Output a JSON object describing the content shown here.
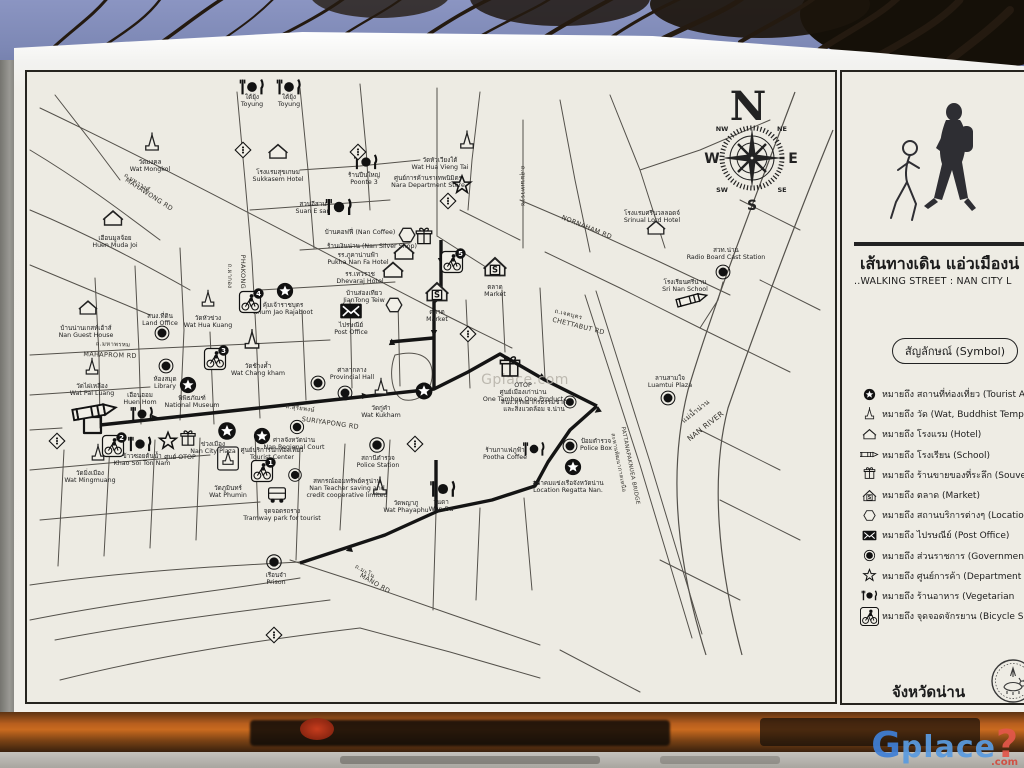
{
  "colors": {
    "sky": "#7d88b5",
    "paper": "#edebe3",
    "ink": "#1c1c1c",
    "wood": "#b85f1e",
    "logo_blue": "#3f7fd6",
    "logo_red": "#e2574a"
  },
  "sign": {
    "title_th": "เส้นทางเดิน แอ่วเมืองน่",
    "title_en": "..WALKING STREET : NAN CITY L",
    "symbol_header": "สัญลักษณ์ (Symbol)",
    "province": "จังหวัดน่าน",
    "legend": [
      {
        "icon": "star-solid",
        "text": "หมายถึง สถานที่ท่องเที่ยว (Tourist Att"
      },
      {
        "icon": "wat",
        "text": "หมายถึง วัด (Wat, Buddhist Temple"
      },
      {
        "icon": "house",
        "text": "หมายถึง โรงแรม (Hotel)"
      },
      {
        "icon": "pencil",
        "text": "หมายถึง โรงเรียน (School)"
      },
      {
        "icon": "gift",
        "text": "หมายถึง ร้านขายของที่ระลึก (Souven"
      },
      {
        "icon": "market",
        "text": "หมายถึง ตลาด (Market)"
      },
      {
        "icon": "hex",
        "text": "หมายถึง สถานบริการต่างๆ (Locatio"
      },
      {
        "icon": "post",
        "text": "หมายถึง ไปรษณีย์ (Post Office)"
      },
      {
        "icon": "gov",
        "text": "หมายถึง ส่วนราชการ (Government"
      },
      {
        "icon": "star-outline",
        "text": "หมายถึง ศูนย์การค้า (Department S"
      },
      {
        "icon": "rest",
        "text": "หมายถึง ร้านอาหาร (Vegetarian"
      },
      {
        "icon": "bike",
        "text": "หมายถึง จุดจอดจักรยาน (Bicycle S"
      }
    ]
  },
  "map": {
    "watermark": "Gplace.com",
    "compass": {
      "n": "N",
      "s": "S",
      "e": "E",
      "w": "W",
      "nw": "NW",
      "ne": "NE",
      "sw": "SW",
      "se": "SE"
    },
    "roads": [
      {
        "text": "ถ.มหาวงศ์",
        "x": 136,
        "y": 184,
        "rot": 33,
        "size": 6
      },
      {
        "text": "MAHAWONG RD",
        "x": 148,
        "y": 196,
        "rot": 33,
        "size": 6.5
      },
      {
        "text": "ถ.มหาพรหม",
        "x": 113,
        "y": 346,
        "rot": 2,
        "size": 6
      },
      {
        "text": "MAHAPROM RD",
        "x": 110,
        "y": 357,
        "rot": 2,
        "size": 6.5
      },
      {
        "text": "ถ.ผากอง",
        "x": 228,
        "y": 276,
        "rot": 90,
        "size": 6
      },
      {
        "text": "PHAKONG RD",
        "x": 241,
        "y": 278,
        "rot": 90,
        "size": 6.5
      },
      {
        "text": "ถ.สุริยพงษ์",
        "x": 300,
        "y": 410,
        "rot": 8,
        "size": 6
      },
      {
        "text": "SURIYAPONG RD",
        "x": 330,
        "y": 425,
        "rot": 8,
        "size": 6.5
      },
      {
        "text": "ถ.สุมนเทวราช",
        "x": 521,
        "y": 186,
        "rot": 90,
        "size": 6
      },
      {
        "text": "NORNAHAM RD",
        "x": 586,
        "y": 229,
        "rot": 22,
        "size": 6.5
      },
      {
        "text": "ถ.เจตบุตร",
        "x": 568,
        "y": 316,
        "rot": 14,
        "size": 6
      },
      {
        "text": "CHETTABUT RD",
        "x": 578,
        "y": 328,
        "rot": 14,
        "size": 6.5
      },
      {
        "text": "ถ.มะโน",
        "x": 364,
        "y": 573,
        "rot": 30,
        "size": 6
      },
      {
        "text": "MANO RD",
        "x": 374,
        "y": 585,
        "rot": 30,
        "size": 6.5
      },
      {
        "text": "แม่น้ำน่าน",
        "x": 697,
        "y": 413,
        "rot": -38,
        "size": 7
      },
      {
        "text": "NAN RIVER",
        "x": 707,
        "y": 428,
        "rot": -38,
        "size": 7.5
      },
      {
        "text": "สะพานพัฒนาภาคเหนือ",
        "x": 617,
        "y": 463,
        "rot": 79,
        "size": 5.5
      },
      {
        "text": "PATTANAPAKNUEA BRIDGE",
        "x": 629,
        "y": 466,
        "rot": 79,
        "size": 5.5
      }
    ],
    "pois": [
      {
        "t": "wat",
        "x": 152,
        "y": 150,
        "s": 1.3,
        "lines": [
          "วัดมงคล",
          "Wat Mongkol"
        ],
        "lx": 150,
        "ly": 164
      },
      {
        "t": "wat",
        "x": 467,
        "y": 148,
        "s": 1.3,
        "lines": [
          "วัดหัวเวียงใต้",
          "Wat Hua Vieng Tai"
        ],
        "lx": 440,
        "ly": 162
      },
      {
        "t": "wat",
        "x": 208,
        "y": 306,
        "s": 1.2,
        "lines": [
          "วัดหัวข่วง",
          "Wat Hua Kuang"
        ],
        "lx": 208,
        "ly": 320
      },
      {
        "t": "wat",
        "x": 92,
        "y": 374,
        "s": 1.2,
        "lines": [
          "วัดไผ่เหลือง",
          "Wat Pai Luang"
        ],
        "lx": 92,
        "ly": 388
      },
      {
        "t": "wat",
        "x": 252,
        "y": 348,
        "s": 1.4,
        "lines": [
          "วัดช้างค้ำ",
          "Wat Chang kham"
        ],
        "lx": 258,
        "ly": 368
      },
      {
        "t": "wat-box",
        "x": 228,
        "y": 466,
        "s": 1.15,
        "lines": [
          "วัดภูมินทร์",
          "Wat Phumin"
        ],
        "lx": 228,
        "ly": 490
      },
      {
        "t": "wat",
        "x": 98,
        "y": 460,
        "s": 1.2,
        "lines": [
          "วัดมิ่งเมือง",
          "Wat Mingmuang"
        ],
        "lx": 90,
        "ly": 475
      },
      {
        "t": "wat",
        "x": 381,
        "y": 394,
        "s": 1.2,
        "lines": [
          "วัดกู่คำ",
          "Wat Kukham"
        ],
        "lx": 381,
        "ly": 410
      },
      {
        "t": "wat",
        "x": 380,
        "y": 494,
        "s": 1.3,
        "lines": [
          "วัดพญาภู",
          "Wat Phayaphu"
        ],
        "lx": 406,
        "ly": 505
      },
      {
        "t": "house",
        "x": 113,
        "y": 225,
        "s": 1.3,
        "lines": [
          "เฮือนมูลจ้อย",
          "Huen Muda Joi"
        ],
        "lx": 115,
        "ly": 240
      },
      {
        "t": "house",
        "x": 88,
        "y": 314,
        "s": 1.2,
        "lines": [
          "บ้านน่านเกสท์เฮ้าส์",
          "Nan Guest House"
        ],
        "lx": 86,
        "ly": 330
      },
      {
        "t": "house",
        "x": 278,
        "y": 158,
        "s": 1.25,
        "lines": [
          "โรงแรมสุขเกษม",
          "Sukkasem Hotel"
        ],
        "lx": 278,
        "ly": 174
      },
      {
        "t": "house",
        "x": 404,
        "y": 259,
        "s": 1.35,
        "lines": [
          "รร.ภูคาน่านฟ้า",
          "Pukha Nan Fa Hotel"
        ],
        "lx": 358,
        "ly": 257
      },
      {
        "t": "house",
        "x": 393,
        "y": 277,
        "s": 1.35,
        "lines": [
          "รร.เทวราช",
          "Dhevaraj Hotel"
        ],
        "lx": 360,
        "ly": 276
      },
      {
        "t": "house",
        "x": 656,
        "y": 234,
        "s": 1.2,
        "lines": [
          "โรงแรมศรีนวลลอดจ์",
          "Srinual Lord Hotel"
        ],
        "lx": 652,
        "ly": 215
      },
      {
        "t": "rest",
        "x": 252,
        "y": 87,
        "s": 1.35,
        "lines": [
          "ใต้ยุ้ง",
          "Toyung"
        ],
        "lx": 252,
        "ly": 99
      },
      {
        "t": "rest",
        "x": 289,
        "y": 87,
        "s": 1.35,
        "lines": [
          "ใต้ยุ้ง",
          "Toyung"
        ],
        "lx": 289,
        "ly": 99
      },
      {
        "t": "rest",
        "x": 339,
        "y": 207,
        "s": 1.45,
        "lines": [
          "สวนอีสาน",
          "Suan E san"
        ],
        "lx": 313,
        "ly": 206
      },
      {
        "t": "rest",
        "x": 366,
        "y": 162,
        "s": 1.3,
        "lines": [
          "ร้านปืนใหญ่",
          "Poonte 3"
        ],
        "lx": 364,
        "ly": 177
      },
      {
        "t": "rest",
        "x": 142,
        "y": 414,
        "s": 1.25,
        "lines": [
          "เฮือนฮอม",
          "Huen Hom"
        ],
        "lx": 140,
        "ly": 397
      },
      {
        "t": "rest",
        "x": 140,
        "y": 444,
        "s": 1.3,
        "lines": [
          "ข้าวซอยต้นน้ำ",
          "Khao Soi Ton Nam"
        ],
        "lx": 142,
        "ly": 458
      },
      {
        "t": "rest",
        "x": 443,
        "y": 489,
        "s": 1.4,
        "lines": [
          "วันดา",
          "Wun Da"
        ],
        "lx": 441,
        "ly": 504
      },
      {
        "t": "rest",
        "x": 534,
        "y": 449,
        "s": 1.2,
        "lines": [
          "ร้านกาแฟภูฟ้า",
          "Pootha Coffee"
        ],
        "lx": 505,
        "ly": 452
      },
      {
        "t": "market",
        "x": 495,
        "y": 274,
        "s": 1.5,
        "lines": [
          "ตลาด",
          "Market"
        ],
        "lx": 495,
        "ly": 289
      },
      {
        "t": "market",
        "x": 437,
        "y": 299,
        "s": 1.5,
        "lines": [
          "ตลาด",
          "Market"
        ],
        "lx": 437,
        "ly": 314
      },
      {
        "t": "post",
        "x": 351,
        "y": 311,
        "s": 1.35,
        "lines": [
          "ไปรษณีย์",
          "Post Office"
        ],
        "lx": 351,
        "ly": 327
      },
      {
        "t": "gov",
        "x": 162,
        "y": 333,
        "s": 1.15,
        "lines": [
          "สนง.ที่ดิน",
          "Land Office"
        ],
        "lx": 160,
        "ly": 318
      },
      {
        "t": "gov",
        "x": 166,
        "y": 366,
        "s": 1.15,
        "lines": [
          "ห้องสมุด",
          "Library"
        ],
        "lx": 165,
        "ly": 381
      },
      {
        "t": "gov",
        "x": 318,
        "y": 383,
        "s": 1.15,
        "lines": [
          "ศาลากลาง",
          "Provincial Hall"
        ],
        "lx": 352,
        "ly": 372
      },
      {
        "t": "gov",
        "x": 345,
        "y": 393,
        "s": 1.15
      },
      {
        "t": "gov",
        "x": 297,
        "y": 427,
        "s": 1.1,
        "lines": [
          "ศาลจังหวัดน่าน",
          "Nan Regional Court"
        ],
        "lx": 294,
        "ly": 442
      },
      {
        "t": "gov",
        "x": 377,
        "y": 445,
        "s": 1.2,
        "lines": [
          "สถานีตำรวจ",
          "Police Station"
        ],
        "lx": 378,
        "ly": 460
      },
      {
        "t": "gov",
        "x": 295,
        "y": 475,
        "s": 1.05,
        "lines": [
          "สหกรณ์ออมทรัพย์ครูน่าน",
          "Nan Teacher saving and",
          "credit cooperative limited"
        ],
        "lx": 347,
        "ly": 483
      },
      {
        "t": "gov",
        "x": 570,
        "y": 446,
        "s": 1.15,
        "lines": [
          "ป้อมตำรวจ",
          "Police Box"
        ],
        "lx": 596,
        "ly": 443
      },
      {
        "t": "gov",
        "x": 668,
        "y": 398,
        "s": 1.15,
        "lines": [
          "ลานสามใจ",
          "Luamtui Plaza"
        ],
        "lx": 670,
        "ly": 380
      },
      {
        "t": "gov",
        "x": 723,
        "y": 272,
        "s": 1.15,
        "lines": [
          "สวท.น่าน",
          "Radio Board Cast Station"
        ],
        "lx": 726,
        "ly": 252
      },
      {
        "t": "gov",
        "x": 274,
        "y": 562,
        "s": 1.2,
        "lines": [
          "เรือนจำ",
          "Prison"
        ],
        "lx": 276,
        "ly": 577
      },
      {
        "t": "gov",
        "x": 570,
        "y": 402,
        "s": 1.0,
        "lines": [
          "สนง.ทรัพยากรธรรมชาติ",
          "และสิ่งแวดล้อม จ.น่าน"
        ],
        "lx": 534,
        "ly": 404
      },
      {
        "t": "star-solid",
        "x": 188,
        "y": 385,
        "s": 1.25,
        "lines": [
          "พิพิธภัณฑ์",
          "National Museum"
        ],
        "lx": 192,
        "ly": 400
      },
      {
        "t": "star-solid",
        "x": 227,
        "y": 431,
        "s": 1.35,
        "lines": [
          "ข่วงเมือง",
          "Nan City Plaza"
        ],
        "lx": 213,
        "ly": 446
      },
      {
        "t": "star-solid",
        "x": 262,
        "y": 436,
        "s": 1.25,
        "lines": [
          "ศูนย์บริการนักท่องเที่ยว",
          "Tourist Center"
        ],
        "lx": 272,
        "ly": 452
      },
      {
        "t": "star-solid",
        "x": 285,
        "y": 291,
        "s": 1.25,
        "lines": [
          "คุ้มเจ้าราชบุตร",
          "Khum Jao Rajaboot"
        ],
        "lx": 283,
        "ly": 307
      },
      {
        "t": "star-solid",
        "x": 424,
        "y": 391,
        "s": 1.3
      },
      {
        "t": "star-solid",
        "x": 573,
        "y": 467,
        "s": 1.25,
        "lines": [
          "สมาคมแข่งเรือจังหวัดน่าน",
          "Location Regatta Nan."
        ],
        "lx": 568,
        "ly": 485
      },
      {
        "t": "star-outline",
        "x": 462,
        "y": 185,
        "s": 1.3,
        "lines": [
          "ศูนย์การค้านราเทพนิมิตร",
          "Nara Department Store"
        ],
        "lx": 428,
        "ly": 180
      },
      {
        "t": "star-outline",
        "x": 168,
        "y": 441,
        "s": 1.25,
        "lines": [
          "ศูนย์ OTOP"
        ],
        "lx": 180,
        "ly": 459
      },
      {
        "t": "gift",
        "x": 424,
        "y": 238,
        "s": 1.25,
        "lines": [
          "ร้านเงินน่าน (Nan Silver Shop)"
        ],
        "lx": 372,
        "ly": 248
      },
      {
        "t": "gift",
        "x": 188,
        "y": 440,
        "s": 1.15
      },
      {
        "t": "gift",
        "x": 510,
        "y": 369,
        "s": 1.55,
        "lines": [
          "OTOP",
          "ศูนย์เมืองเก่าน่าน",
          "One Tambon One Product"
        ],
        "lx": 523,
        "ly": 387
      },
      {
        "t": "hex",
        "x": 407,
        "y": 235,
        "s": 1.2,
        "lines": [
          "บ้านคอฟฟี่ (Nan Coffee)"
        ],
        "lx": 360,
        "ly": 234
      },
      {
        "t": "hex",
        "x": 394,
        "y": 305,
        "s": 1.2,
        "lines": [
          "บ้านส่องเทียว",
          "JianTong Teiw"
        ],
        "lx": 364,
        "ly": 295
      },
      {
        "t": "pencil",
        "x": 96,
        "y": 411,
        "s": 2.1,
        "rot": -10
      },
      {
        "t": "pencil",
        "x": 693,
        "y": 299,
        "s": 1.5,
        "rot": -15,
        "lines": [
          "โรงเรียนศรีน่าน",
          "Sri Nan School"
        ],
        "lx": 685,
        "ly": 284
      },
      {
        "t": "bike",
        "x": 262,
        "y": 471,
        "s": 1.0,
        "num": "1"
      },
      {
        "t": "bike",
        "x": 113,
        "y": 446,
        "s": 1.0,
        "num": "2"
      },
      {
        "t": "bike",
        "x": 215,
        "y": 359,
        "s": 1.0,
        "num": "3"
      },
      {
        "t": "bike",
        "x": 250,
        "y": 302,
        "s": 1.0,
        "num": "4"
      },
      {
        "t": "bike",
        "x": 452,
        "y": 262,
        "s": 1.0,
        "num": "5"
      },
      {
        "t": "tram",
        "x": 277,
        "y": 495,
        "s": 1.2,
        "lines": [
          "จุดจอดรถราง",
          "Tramway park for tourist"
        ],
        "lx": 282,
        "ly": 513
      },
      {
        "t": "diamond",
        "x": 57,
        "y": 441,
        "s": 1.1
      },
      {
        "t": "diamond",
        "x": 243,
        "y": 150,
        "s": 1.1
      },
      {
        "t": "diamond",
        "x": 358,
        "y": 152,
        "s": 1.1
      },
      {
        "t": "diamond",
        "x": 448,
        "y": 201,
        "s": 1.1
      },
      {
        "t": "diamond",
        "x": 468,
        "y": 334,
        "s": 1.1
      },
      {
        "t": "diamond",
        "x": 415,
        "y": 444,
        "s": 1.1
      },
      {
        "t": "diamond",
        "x": 274,
        "y": 635,
        "s": 1.1
      }
    ]
  },
  "watermark_logo": {
    "g": "G",
    "place": "place",
    "q": "?",
    "com": ".com"
  }
}
